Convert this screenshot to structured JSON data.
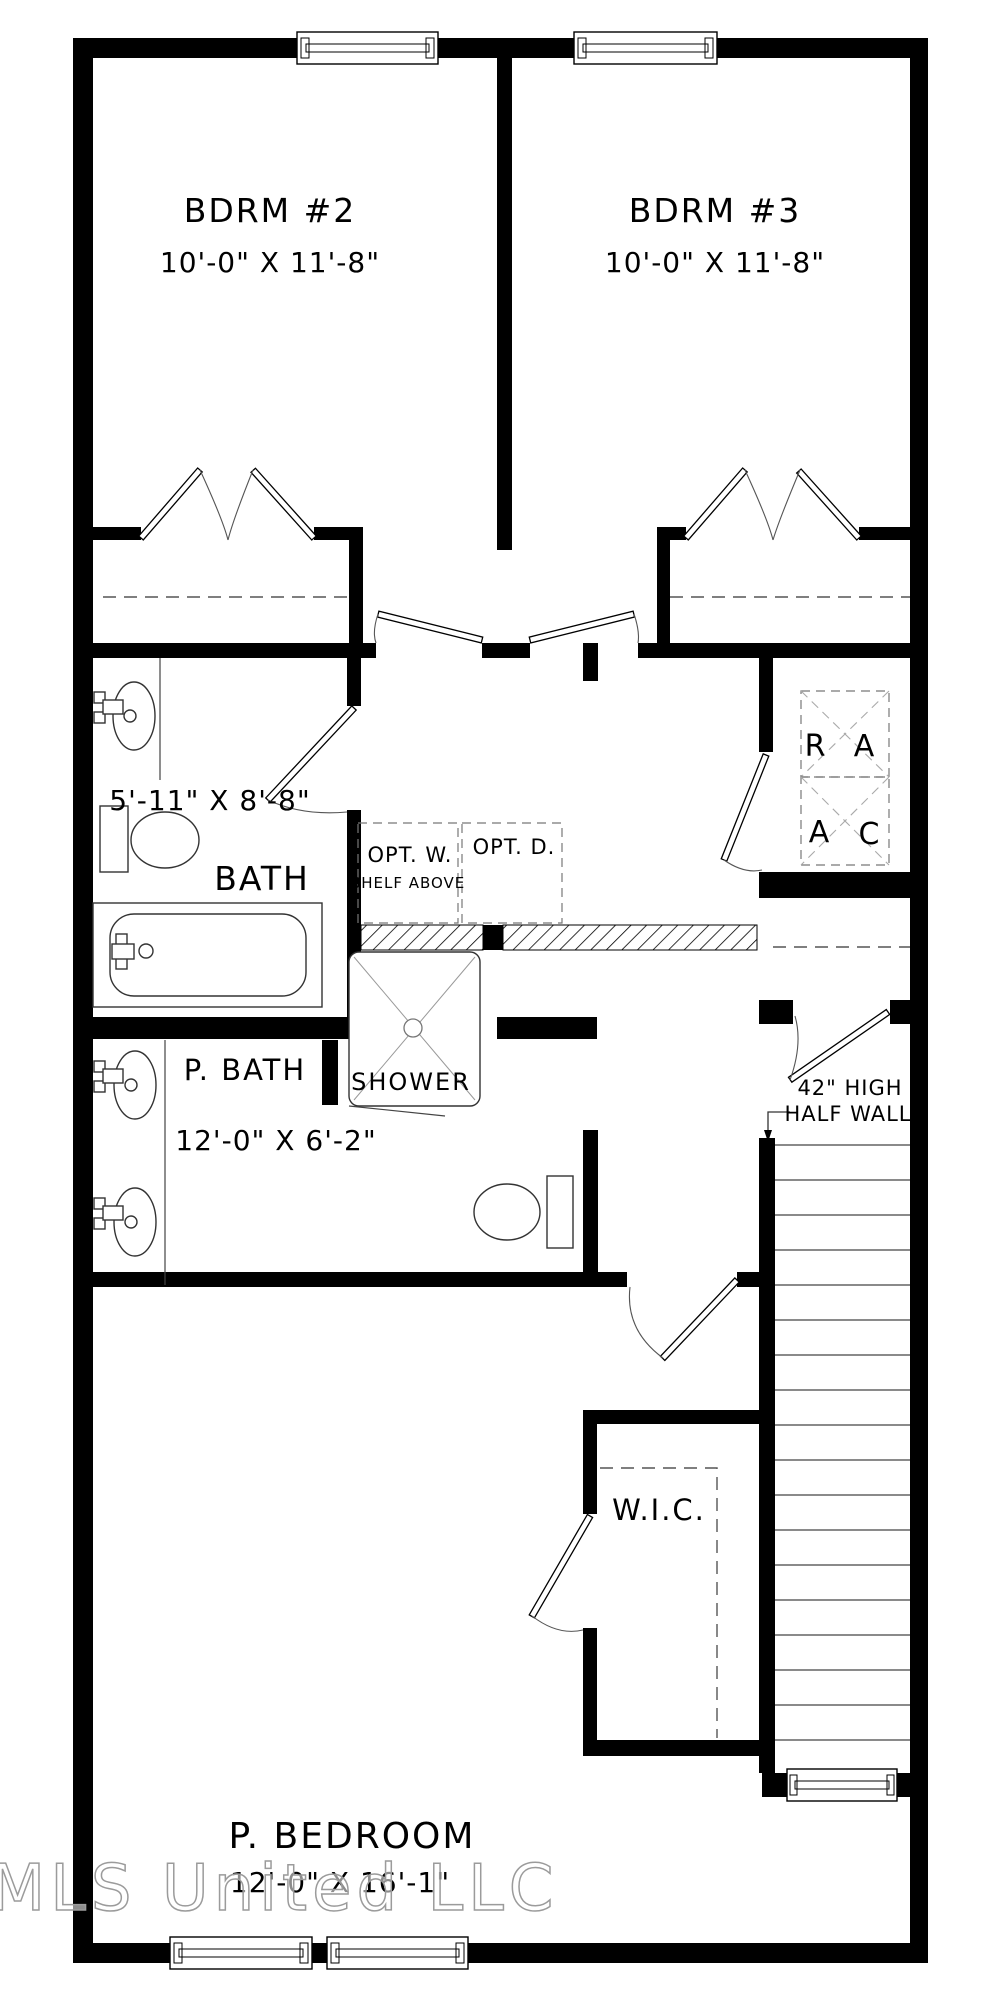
{
  "floor_plan": {
    "rooms": {
      "bedroom2": {
        "name": "BDRM #2",
        "dims": "10'-0\" X 11'-8\""
      },
      "bedroom3": {
        "name": "BDRM #3",
        "dims": "10'-0\" X 11'-8\""
      },
      "bath": {
        "name": "BATH",
        "dims": "5'-11\" X 8'-8\""
      },
      "primary_bath": {
        "name": "P. BATH",
        "dims": "12'-0\" X 6'-2\""
      },
      "primary_bedroom": {
        "name": "P. BEDROOM",
        "dims": "12'-0\" X 16'-1\""
      },
      "wic": {
        "name": "W.I.C."
      },
      "shower": {
        "name": "SHOWER"
      }
    },
    "laundry": {
      "washer": "OPT. W.",
      "washer_note": "SHELF ABOVE",
      "dryer": "OPT. D."
    },
    "mech": {
      "return_air_r": "R",
      "return_air_a": "A",
      "ac_a": "A",
      "ac_c": "C"
    },
    "annotations": {
      "half_wall_line1": "42\" HIGH",
      "half_wall_line2": "HALF WALL"
    },
    "watermark": "MLS United LLC",
    "colors": {
      "wall": "#000000",
      "line": "#444444",
      "dash": "#555555",
      "watermark": "#9b9b9b"
    }
  }
}
